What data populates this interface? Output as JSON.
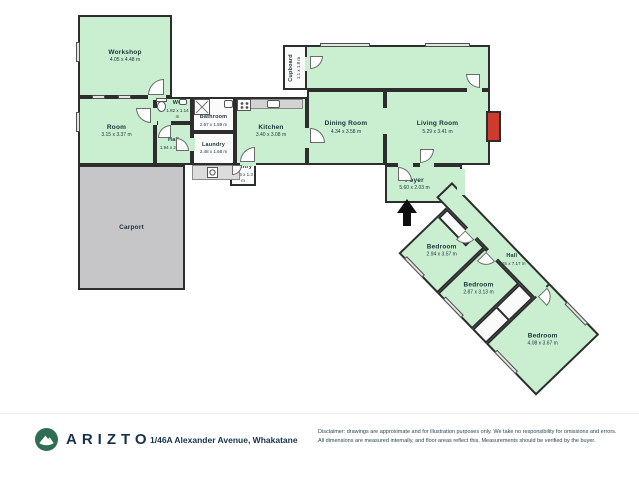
{
  "plan": {
    "rooms": {
      "workshop": {
        "name": "Workshop",
        "dims": "4.05 x 4.48 m"
      },
      "room": {
        "name": "Room",
        "dims": "3.15 x 3.37 m"
      },
      "wc": {
        "name": "WC",
        "dims": "1.82 x 1.14 m"
      },
      "hall": {
        "name": "Hall",
        "dims": "1.94 x 2.33 m"
      },
      "bathroom": {
        "name": "Bathroom",
        "dims": "2.67 x 1.59 m"
      },
      "laundry": {
        "name": "Laundry",
        "dims": "2.48 x 1.68 m"
      },
      "kitchen": {
        "name": "Kitchen",
        "dims": "3.40 x 3.08 m"
      },
      "dining": {
        "name": "Dining Room",
        "dims": "4.34 x 3.58 m"
      },
      "living": {
        "name": "Living Room",
        "dims": "5.29 x 3.41 m"
      },
      "cupboard": {
        "name": "Cupboard",
        "dims": "1.1 x 1.8 m"
      },
      "pantry": {
        "name": "Pantry",
        "dims": "1.15 x 1.3 m"
      },
      "foyer": {
        "name": "Foyer",
        "dims": "5.60 x 2.03 m"
      },
      "carport": {
        "name": "Carport"
      },
      "bedroom1": {
        "name": "Bedroom",
        "dims": "2.94 x 3.57 m"
      },
      "hall2": {
        "name": "Hall",
        "dims": "1.15 x 7.17 m"
      },
      "bedroom2": {
        "name": "Bedroom",
        "dims": "2.87 x 3.13 m"
      },
      "bedroom3": {
        "name": "Bedroom",
        "dims": "4.08 x 3.67 m"
      }
    },
    "icons": {
      "entrance_arrow": "up-arrow-entrance",
      "toilet": "toilet",
      "shower": "shower-box-x",
      "stove": "stove-four-burners",
      "sink": "sink",
      "washer": "washing-machine",
      "fireplace": "fireplace"
    },
    "colors": {
      "room_fill": "#c9efd0",
      "wall": "#2d2d2d",
      "carport_fill": "#c6c6c8",
      "fireplace": "#cf3a2e"
    }
  },
  "footer": {
    "brand": "ARIZTO",
    "address": "1/46A Alexander Avenue, Whakatane",
    "disclaimer_line1": "Disclaimer: drawings are approximate and for illustration purposes only. We take no responsibility for omissions and errors.",
    "disclaimer_line2": "All dimensions are measured internally, and floor areas reflect this. Measurements should be verified by the buyer.",
    "colors": {
      "brand_navy": "#16324c",
      "logo_green": "#2f6e55"
    }
  }
}
